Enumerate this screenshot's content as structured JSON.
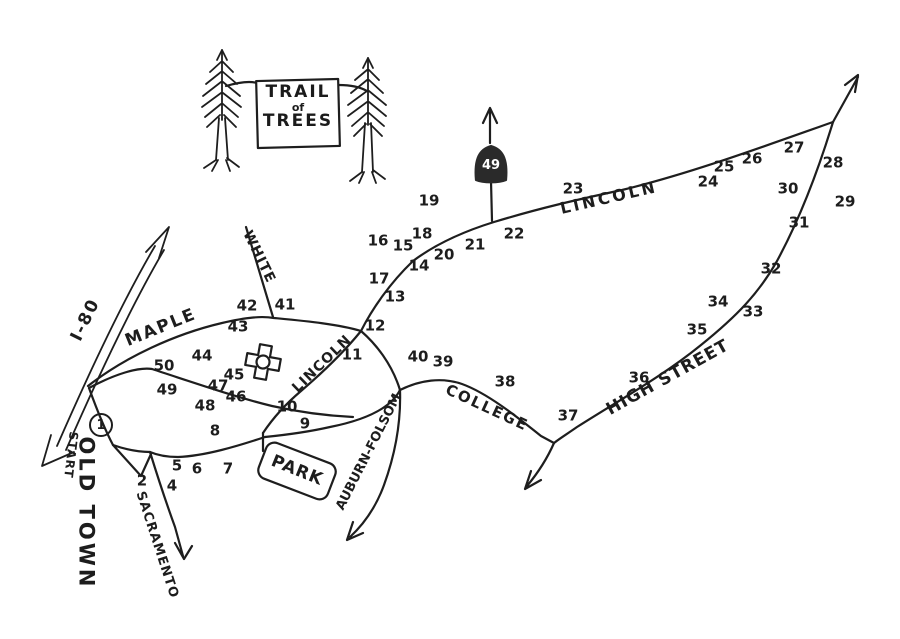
{
  "sign": {
    "line1": "TRAIL",
    "line2": "of",
    "line3": "TREES"
  },
  "highway_shield": {
    "route": "49"
  },
  "colors": {
    "ink": "#1e1e1e",
    "paper": "#ffffff",
    "shield_fill": "#2a2a2a",
    "shield_text": "#ffffff"
  },
  "street_labels": [
    {
      "name": "label-maple",
      "text": "MAPLE",
      "x": 161,
      "y": 328,
      "rotate": -22,
      "size": 17,
      "spacing": 2
    },
    {
      "name": "label-white",
      "text": "WHITE",
      "x": 259,
      "y": 257,
      "rotate": 64,
      "size": 14,
      "spacing": 1
    },
    {
      "name": "label-lincoln-inner",
      "text": "LINCOLN",
      "x": 322,
      "y": 364,
      "rotate": -44,
      "size": 14,
      "spacing": 1
    },
    {
      "name": "label-lincoln-upper",
      "text": "LINCOLN",
      "x": 609,
      "y": 198,
      "rotate": -13,
      "size": 16,
      "spacing": 3
    },
    {
      "name": "label-high-street",
      "text": "HIGH STREET",
      "x": 668,
      "y": 378,
      "rotate": -29,
      "size": 17,
      "spacing": 1
    },
    {
      "name": "label-college",
      "text": "COLLEGE",
      "x": 487,
      "y": 408,
      "rotate": 25,
      "size": 15,
      "spacing": 2
    },
    {
      "name": "label-sacramento",
      "text": "SACRAMENTO",
      "x": 157,
      "y": 545,
      "rotate": 72,
      "size": 13,
      "spacing": 1
    },
    {
      "name": "label-auburn-folsom",
      "text": "AUBURN-FOLSOM",
      "x": 369,
      "y": 452,
      "rotate": -63,
      "size": 13,
      "spacing": 0
    },
    {
      "name": "label-i80",
      "text": "I-80",
      "x": 86,
      "y": 320,
      "rotate": -64,
      "size": 17,
      "spacing": 2
    },
    {
      "name": "label-old-town",
      "text": "OLD TOWN",
      "x": 86,
      "y": 513,
      "rotate": 90,
      "size": 21,
      "spacing": 3
    },
    {
      "name": "label-start",
      "text": "START",
      "x": 71,
      "y": 455,
      "rotate": 97,
      "size": 12,
      "spacing": 1
    },
    {
      "name": "label-park",
      "text": "PARK",
      "x": 297,
      "y": 471,
      "rotate": 22,
      "size": 17,
      "spacing": 1
    }
  ],
  "markers": [
    {
      "label": "1",
      "x": 101,
      "y": 425,
      "circled": true
    },
    {
      "label": "2",
      "x": 142,
      "y": 481
    },
    {
      "label": "4",
      "x": 172,
      "y": 486
    },
    {
      "label": "5",
      "x": 177,
      "y": 466
    },
    {
      "label": "6",
      "x": 197,
      "y": 469
    },
    {
      "label": "7",
      "x": 228,
      "y": 469
    },
    {
      "label": "8",
      "x": 215,
      "y": 431
    },
    {
      "label": "9",
      "x": 305,
      "y": 424
    },
    {
      "label": "10",
      "x": 287,
      "y": 407
    },
    {
      "label": "11",
      "x": 352,
      "y": 355
    },
    {
      "label": "12",
      "x": 375,
      "y": 326
    },
    {
      "label": "13",
      "x": 395,
      "y": 297
    },
    {
      "label": "14",
      "x": 419,
      "y": 266
    },
    {
      "label": "15",
      "x": 403,
      "y": 246
    },
    {
      "label": "16",
      "x": 378,
      "y": 241
    },
    {
      "label": "17",
      "x": 379,
      "y": 279
    },
    {
      "label": "18",
      "x": 422,
      "y": 234
    },
    {
      "label": "19",
      "x": 429,
      "y": 201
    },
    {
      "label": "20",
      "x": 444,
      "y": 255
    },
    {
      "label": "21",
      "x": 475,
      "y": 245
    },
    {
      "label": "22",
      "x": 514,
      "y": 234
    },
    {
      "label": "23",
      "x": 573,
      "y": 189
    },
    {
      "label": "24",
      "x": 708,
      "y": 182
    },
    {
      "label": "25",
      "x": 724,
      "y": 167
    },
    {
      "label": "26",
      "x": 752,
      "y": 159
    },
    {
      "label": "27",
      "x": 794,
      "y": 148
    },
    {
      "label": "28",
      "x": 833,
      "y": 163
    },
    {
      "label": "29",
      "x": 845,
      "y": 202
    },
    {
      "label": "30",
      "x": 788,
      "y": 189
    },
    {
      "label": "31",
      "x": 799,
      "y": 223
    },
    {
      "label": "32",
      "x": 771,
      "y": 269
    },
    {
      "label": "33",
      "x": 753,
      "y": 312
    },
    {
      "label": "34",
      "x": 718,
      "y": 302
    },
    {
      "label": "35",
      "x": 697,
      "y": 330
    },
    {
      "label": "36",
      "x": 639,
      "y": 378
    },
    {
      "label": "37",
      "x": 568,
      "y": 416
    },
    {
      "label": "38",
      "x": 505,
      "y": 382
    },
    {
      "label": "39",
      "x": 443,
      "y": 362
    },
    {
      "label": "40",
      "x": 418,
      "y": 357
    },
    {
      "label": "41",
      "x": 285,
      "y": 305
    },
    {
      "label": "42",
      "x": 247,
      "y": 306
    },
    {
      "label": "43",
      "x": 238,
      "y": 327
    },
    {
      "label": "44",
      "x": 202,
      "y": 356
    },
    {
      "label": "45",
      "x": 234,
      "y": 375
    },
    {
      "label": "46",
      "x": 236,
      "y": 397
    },
    {
      "label": "47",
      "x": 218,
      "y": 386
    },
    {
      "label": "48",
      "x": 205,
      "y": 406
    },
    {
      "label": "49",
      "x": 167,
      "y": 390
    },
    {
      "label": "50",
      "x": 164,
      "y": 366
    }
  ]
}
